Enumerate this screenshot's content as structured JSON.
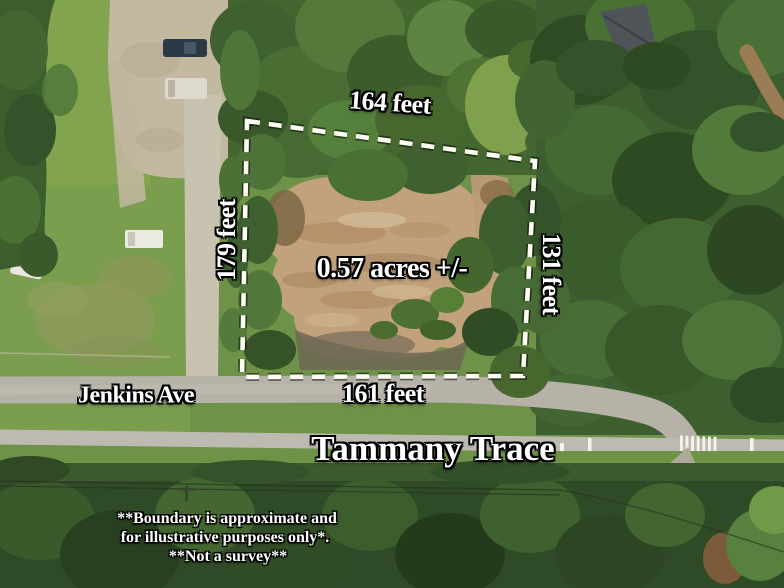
{
  "annotations": {
    "top_length": "164 feet",
    "left_length": "179 feet",
    "right_length": "131 feet",
    "bottom_length": "161 feet",
    "area": "0.57 acres +/-"
  },
  "streets": {
    "road": "Jenkins Ave",
    "trail": "Tammany Trace"
  },
  "disclaimer": {
    "line1": "**Boundary is approximate and",
    "line2": "for illustrative purposes only*.",
    "line3": "**Not a survey**"
  },
  "colors": {
    "boundary_line": "#fcfcf2",
    "label_text": "#ffffff",
    "label_outline": "#000000"
  }
}
